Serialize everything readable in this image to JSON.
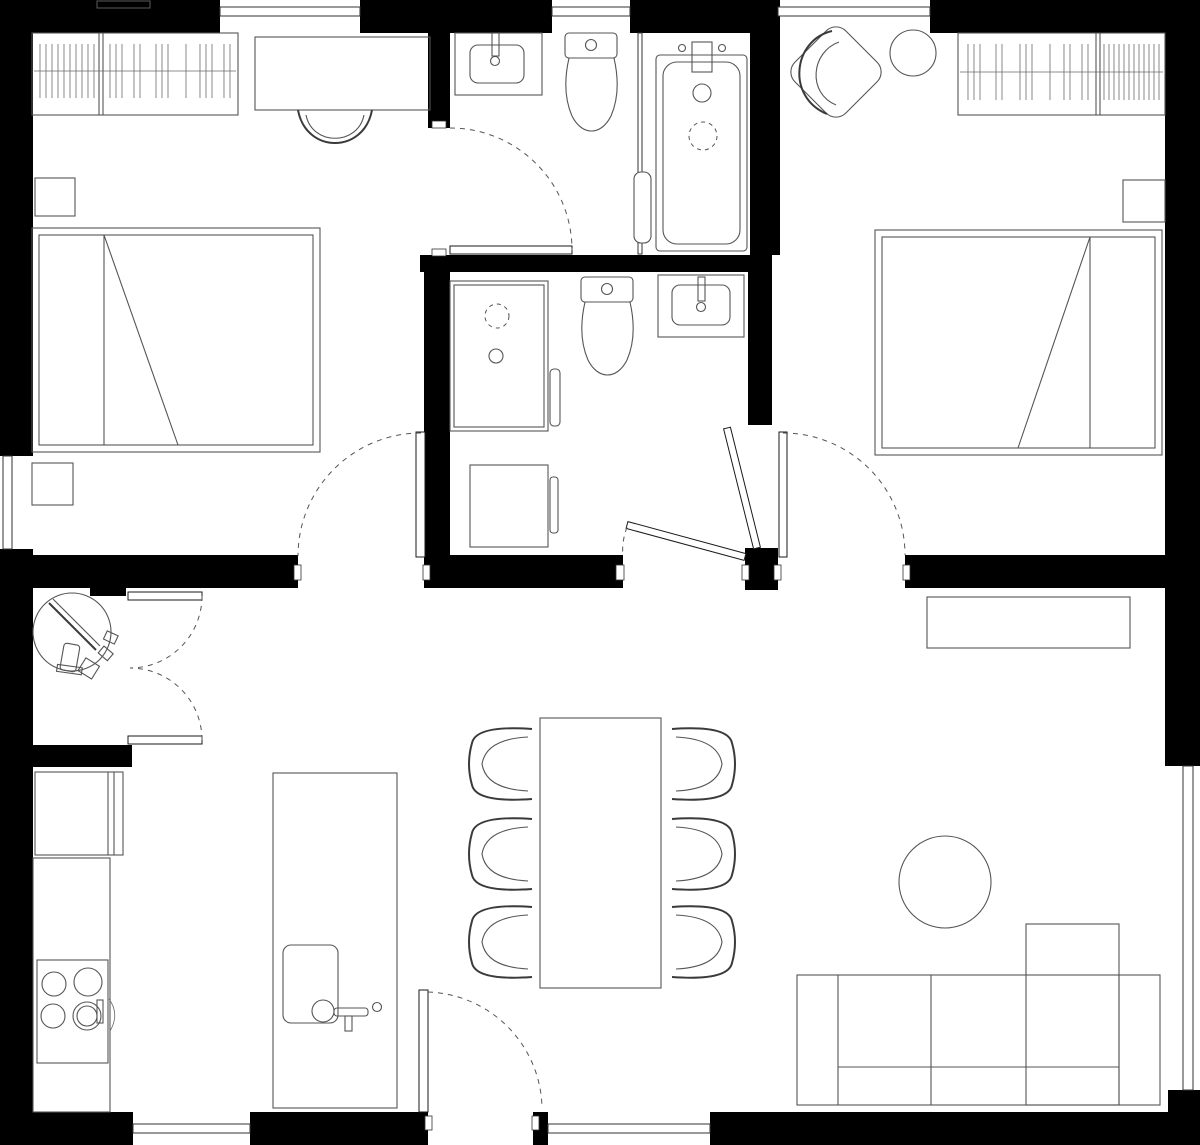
{
  "document": {
    "title": "Two-bedroom apartment floor plan",
    "drawing_type": "architectural floor plan, top view, black and white line drawing"
  },
  "colors": {
    "background": "#ffffff",
    "walls": "#000000",
    "furniture_stroke": "#555555",
    "door_swing": "#555555"
  },
  "rooms": [
    {
      "name": "bedroom-1",
      "label": "Bedroom (top left)",
      "fixtures": [
        "wardrobe with hanging clothes (2 sections)",
        "desk",
        "desk chair",
        "nightstand",
        "double bed with folded-corner line",
        "second nightstand"
      ]
    },
    {
      "name": "bathroom-1",
      "label": "Bathroom (top middle)",
      "fixtures": [
        "vanity sink",
        "toilet",
        "glass partition with towel bar",
        "bathtub with wall faucet, drain and shower head"
      ]
    },
    {
      "name": "bedroom-2",
      "label": "Bedroom (top right)",
      "fixtures": [
        "armchair rotated 45 deg",
        "round side table",
        "wardrobe with hanging clothes (2 sections)",
        "nightstand",
        "double bed with folded-corner line"
      ]
    },
    {
      "name": "bathroom-2",
      "label": "Shower room (middle)",
      "fixtures": [
        "shower enclosure with glass door and handle",
        "toilet",
        "vanity sink",
        "washing machine"
      ]
    },
    {
      "name": "closet",
      "label": "Closet / study nook (middle left)",
      "fixtures": [
        "round table with laptop and small chair",
        "double swing doors"
      ]
    },
    {
      "name": "kitchen",
      "label": "Kitchen (bottom left)",
      "fixtures": [
        "tall cabinet",
        "counter run",
        "stove with 4 burners and oven handle",
        "island with sink and faucet"
      ]
    },
    {
      "name": "dining",
      "label": "Dining area (bottom middle)",
      "fixtures": [
        "rectangular dining table",
        "six chairs, three per long side"
      ]
    },
    {
      "name": "living",
      "label": "Living room (bottom right)",
      "fixtures": [
        "sideboard",
        "round coffee table",
        "sofa with left/right armrests and right chaise"
      ]
    }
  ],
  "openings": {
    "window_count": 7,
    "windows": [
      "top wall left",
      "top wall center",
      "top wall right",
      "left wall",
      "right wall lower",
      "bottom wall left",
      "bottom wall center"
    ],
    "doors": [
      "bedroom-1 swing door to hall",
      "bathroom-1 swing door",
      "bathroom-2 swing door (nearly closed)",
      "bedroom-2 swing door (open, with swing arc)",
      "closet double swing doors",
      "entrance swing door at bottom wall"
    ]
  }
}
